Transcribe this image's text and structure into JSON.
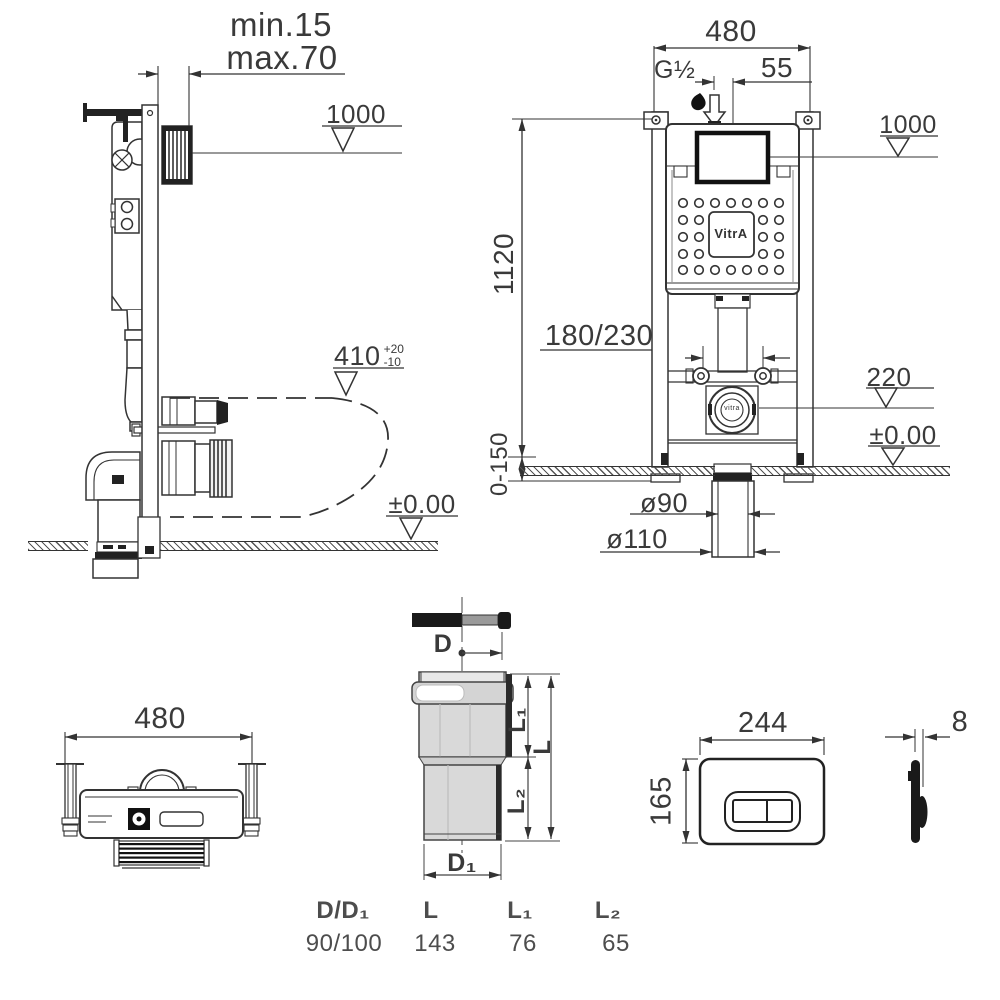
{
  "side_view": {
    "min_label": "min.15",
    "max_label": "max.70",
    "datum_height": "1000",
    "bowl_height": "410",
    "bowl_tol_plus": "+20",
    "bowl_tol_minus": "-10",
    "floor_datum": "±0.00"
  },
  "front_view": {
    "width": "480",
    "inlet_thread": "G½",
    "inlet_offset": "55",
    "datum_height": "1000",
    "frame_height": "1120",
    "supply_spacing": "180/230",
    "outlet_height": "220",
    "floor_datum": "±0.00",
    "foot_adjust": "0-150",
    "drain_inner_dia": "ø90",
    "drain_outer_dia": "ø110",
    "logo": "VitrA",
    "outlet_logo": "vitra"
  },
  "top_view": {
    "width": "480"
  },
  "pipe_detail": {
    "d": "D",
    "d1": "D₁",
    "l": "L",
    "l1": "L₁",
    "l2": "L₂"
  },
  "pipe_table": {
    "headers": [
      "D/D₁",
      "L",
      "L₁",
      "L₂"
    ],
    "values": [
      "90/100",
      "143",
      "76",
      "65"
    ]
  },
  "flush_plate": {
    "width": "244",
    "height": "165",
    "thickness": "8"
  }
}
